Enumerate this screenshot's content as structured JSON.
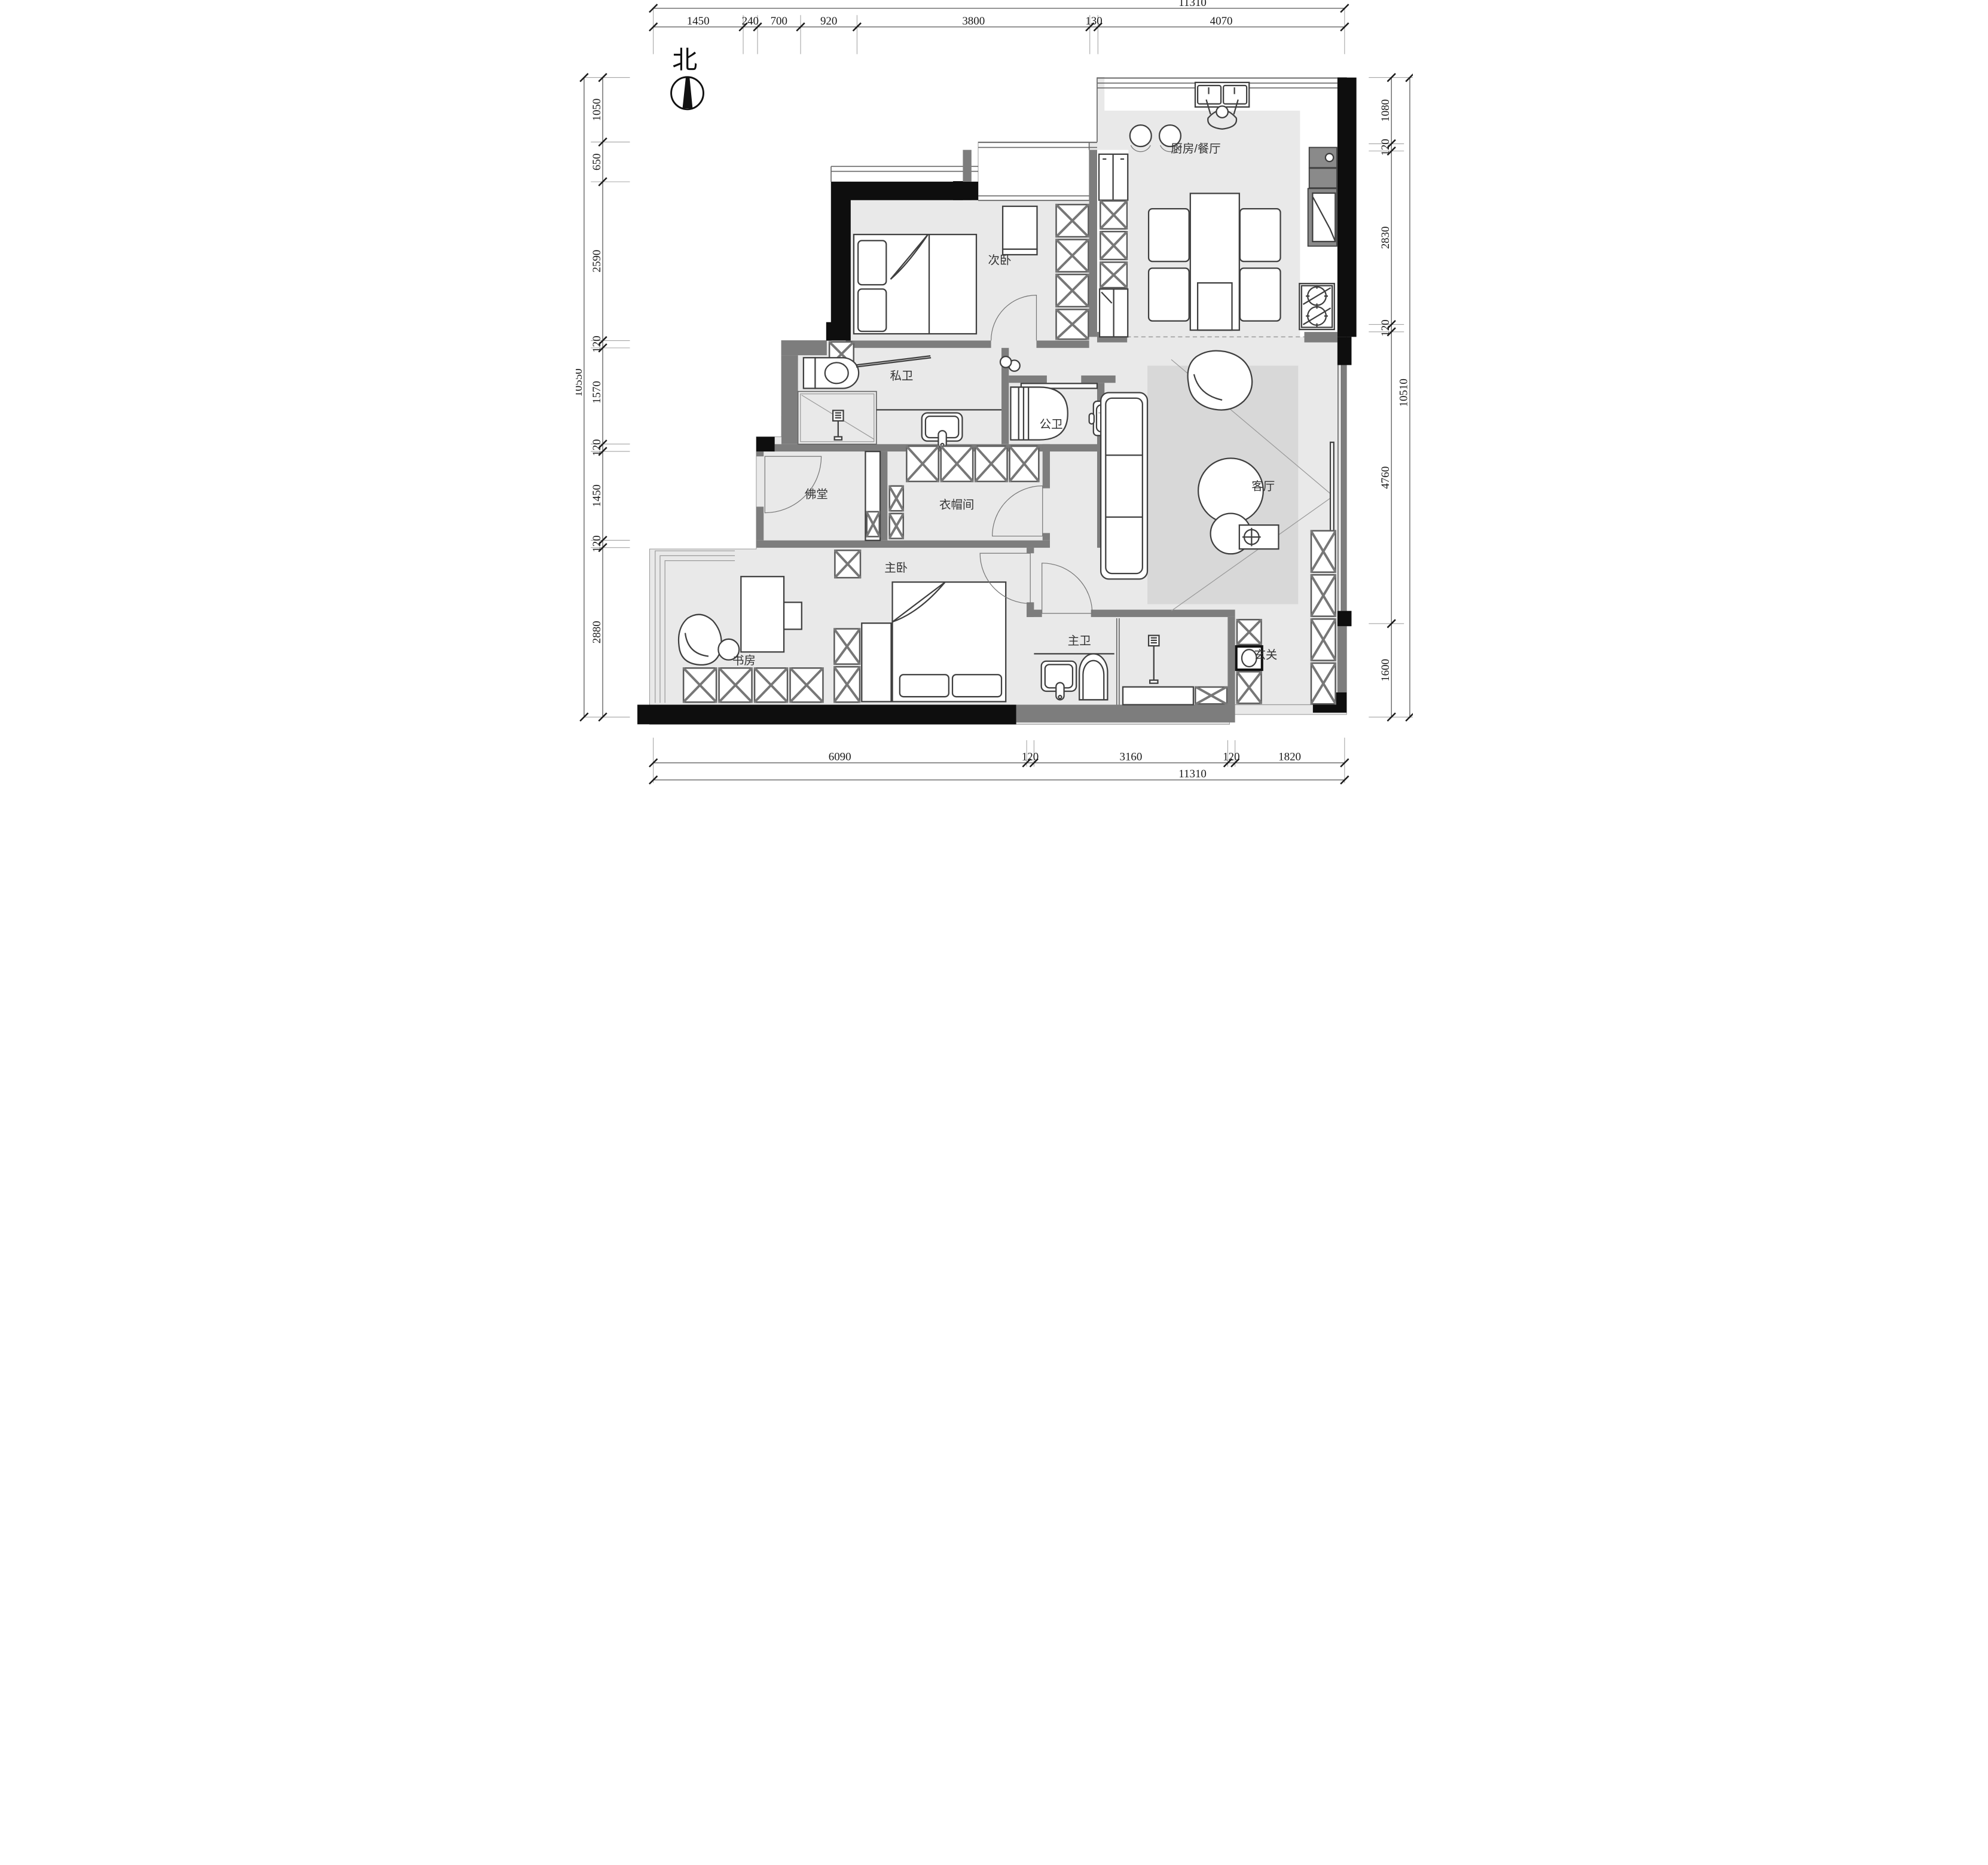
{
  "title": "residential floor plan",
  "north": {
    "label": "北"
  },
  "rooms": {
    "secondary_bedroom": {
      "label": "次卧"
    },
    "kitchen_dining": {
      "label": "厨房/餐厅"
    },
    "private_bath": {
      "label": "私卫"
    },
    "public_bath": {
      "label": "公卫"
    },
    "buddha_hall": {
      "label": "佛堂"
    },
    "cloakroom": {
      "label": "衣帽间"
    },
    "living_room": {
      "label": "客厅"
    },
    "master_bedroom": {
      "label": "主卧"
    },
    "study": {
      "label": "书房"
    },
    "master_bath": {
      "label": "主卫"
    },
    "entry": {
      "label": "玄关"
    }
  },
  "dims": {
    "top": {
      "total": "11310",
      "segments": [
        "1450",
        "240",
        "700",
        "920",
        "3800",
        "130",
        "4070"
      ]
    },
    "bottom": {
      "total": "11310",
      "segments": [
        "6090",
        "120",
        "3160",
        "120",
        "1820"
      ]
    },
    "left": {
      "total": "10550",
      "segments": [
        "1050",
        "650",
        "2590",
        "120",
        "1570",
        "120",
        "1450",
        "120",
        "2880"
      ]
    },
    "right": {
      "total": "10510",
      "segments": [
        "1080",
        "120",
        "2830",
        "120",
        "4760",
        "1600"
      ]
    }
  },
  "colors": {
    "wall_black": "#0e0e0e",
    "wall_gray": "#7d7d7d",
    "floor": "#e9e9e9",
    "rug": "#d8d8d8",
    "dim_text": "#1a1a1a"
  }
}
